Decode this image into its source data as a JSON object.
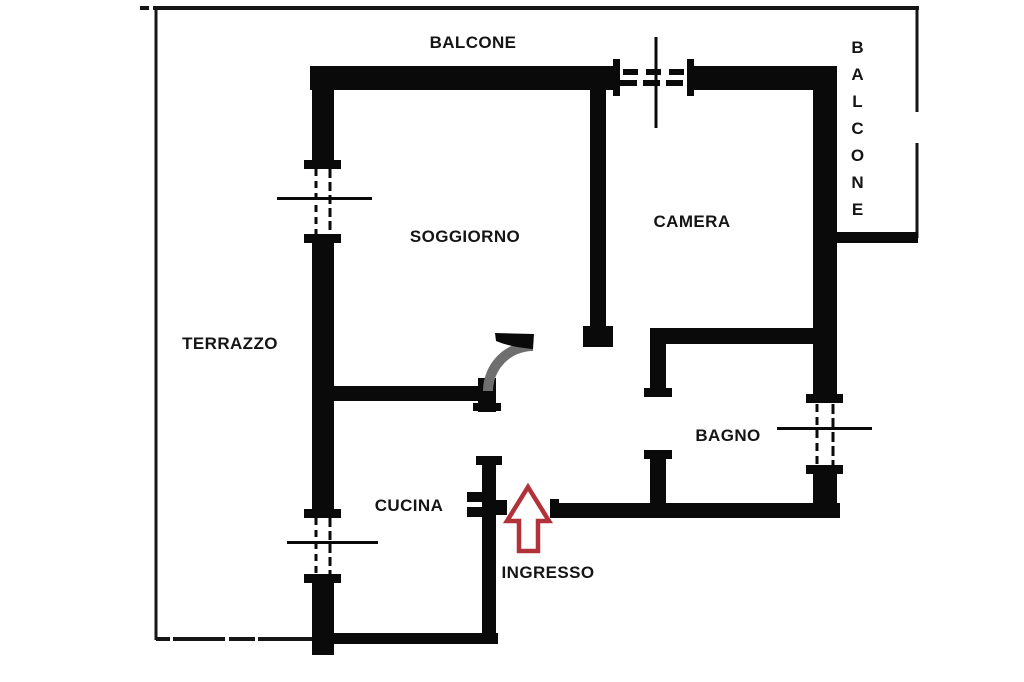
{
  "document": {
    "type": "apartment floor plan"
  },
  "rooms": {
    "balcone_top": "BALCONE",
    "balcone_right": "BALCONE",
    "soggiorno": "SOGGIORNO",
    "camera": "CAMERA",
    "terrazzo": "TERRAZZO",
    "bagno": "BAGNO",
    "cucina": "CUCINA",
    "ingresso": "INGRESSO"
  },
  "icons": {
    "entrance_arrow": "arrow-up-icon"
  },
  "colors": {
    "wall": "#0a0a0a",
    "railing": "#161616",
    "window_detail": "#0a0a0a",
    "door_arc": "#6f6f6f",
    "arrow_red": "#b23239",
    "label_text": "#151515",
    "background": "#ffffff"
  }
}
